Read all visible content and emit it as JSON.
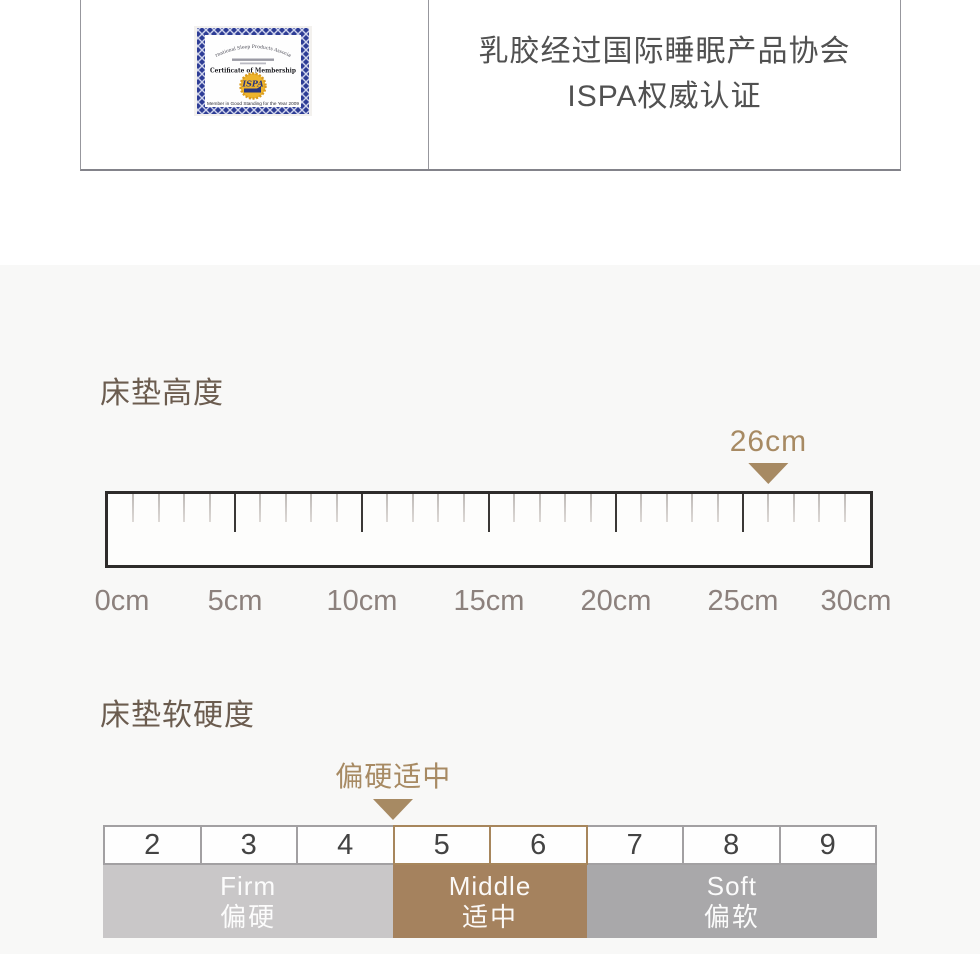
{
  "certification_panel": {
    "caption_line1": "乳胶经过国际睡眠产品协会",
    "caption_line2": "ISPA权威认证",
    "certificate": {
      "arc_text": "International Sleep Products Association",
      "title": "Certificate of Membership",
      "seal_text": "ISPA",
      "footer_text": "Member in Good Standing for the Year 2009"
    }
  },
  "chart_data": [
    {
      "type": "ruler",
      "title": "床垫高度",
      "unit": "cm",
      "axis_min": 0,
      "axis_max": 30,
      "minor_step": 1,
      "major_step": 5,
      "tick_labels": [
        "0cm",
        "5cm",
        "10cm",
        "15cm",
        "20cm",
        "25cm",
        "30cm"
      ],
      "marker": {
        "value": 26,
        "label": "26cm"
      }
    },
    {
      "type": "scale-band",
      "title": "床垫软硬度",
      "scale_numbers": [
        "2",
        "3",
        "4",
        "5",
        "6",
        "7",
        "8",
        "9"
      ],
      "zones": [
        {
          "label_en": "Firm",
          "label_zh": "偏硬",
          "cells": [
            "2",
            "3",
            "4"
          ],
          "color": "#c9c7c8",
          "highlighted": false
        },
        {
          "label_en": "Middle",
          "label_zh": "适中",
          "cells": [
            "5",
            "6"
          ],
          "color": "#a5825e",
          "highlighted": true
        },
        {
          "label_en": "Soft",
          "label_zh": "偏软",
          "cells": [
            "7",
            "8",
            "9"
          ],
          "color": "#a9a8aa",
          "highlighted": false
        }
      ],
      "marker": {
        "label": "偏硬适中",
        "boundary_before_number": "5"
      }
    }
  ],
  "colors": {
    "accent_tan": "#a78a63",
    "heading_brown": "#6b5c4f",
    "section_bg": "#f8f8f7",
    "zone_firm": "#c9c7c8",
    "zone_middle": "#a5825e",
    "zone_soft": "#a9a8aa",
    "cert_border_navy": "#2e3d96",
    "seal_gold": "#eeb42c"
  }
}
